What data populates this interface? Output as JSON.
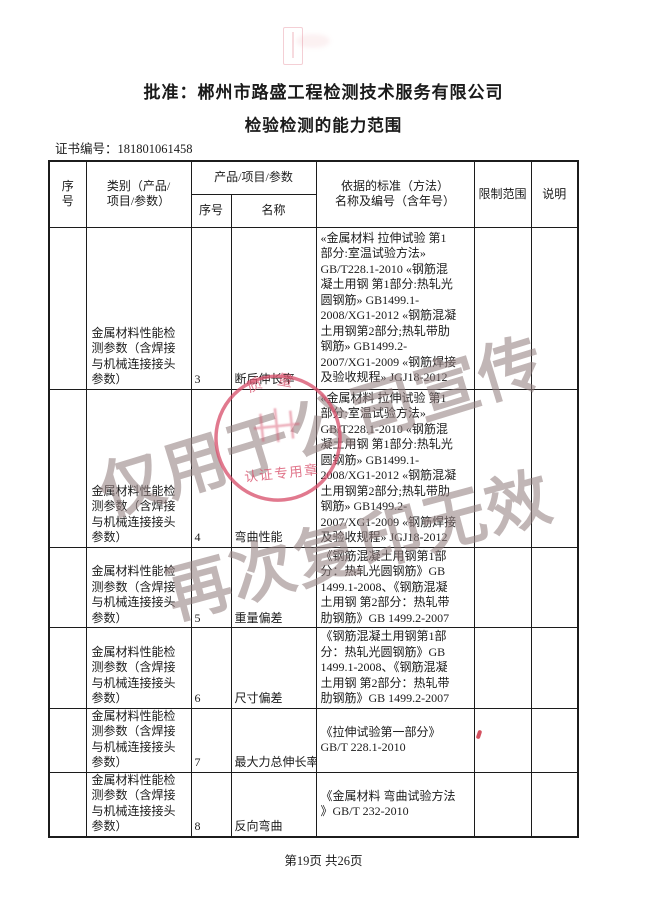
{
  "page": {
    "title_line1": "批准：郴州市路盛工程检测技术服务有限公司",
    "title_line2": "检验检测的能力范围",
    "cert_no_line": "证书编号：181801061458",
    "footer": "第19页  共26页"
  },
  "table": {
    "headers": {
      "col_seq": "序\n号",
      "col_category": "类别（产品/\n项目/参数）",
      "col_group": "产品/项目/参数",
      "col_sub_seq": "序号",
      "col_sub_name": "名称",
      "col_standard": "依据的标准（方法）\n名称及编号（含年号）",
      "col_limit": "限制范围",
      "col_note": "说明"
    },
    "rows": [
      {
        "seq": "",
        "category": "金属材料性能检\n测参数（含焊接\n与机械连接接头\n参数）",
        "no": "3",
        "name": "断后伸长率",
        "standard": "«金属材料 拉伸试验 第1\n部分:室温试验方法»\nGB/T228.1-2010 «钢筋混\n凝土用钢 第1部分:热轧光\n圆钢筋» GB1499.1-\n2008/XG1-2012 «钢筋混凝\n土用钢第2部分;热轧带肋\n钢筋» GB1499.2-\n2007/XG1-2009 «钢筋焊接\n及验收规程» JGJ18-2012",
        "limit": "",
        "note": ""
      },
      {
        "seq": "",
        "category": "金属材料性能检\n测参数（含焊接\n与机械连接接头\n参数）",
        "no": "4",
        "name": "弯曲性能",
        "standard": "«金属材料 拉伸试验 第1\n部分:室温试验方法»\nGB/T228.1-2010 «钢筋混\n凝土用钢 第1部分:热轧光\n圆钢筋» GB1499.1-\n2008/XG1-2012 «钢筋混凝\n土用钢第2部分;热轧带肋\n钢筋» GB1499.2-\n2007/XG1-2009 «钢筋焊接\n及验收规程» JGJ18-2012",
        "limit": "",
        "note": ""
      },
      {
        "seq": "",
        "category": "金属材料性能检\n测参数（含焊接\n与机械连接接头\n参数）",
        "no": "5",
        "name": "重量偏差",
        "standard": "《钢筋混凝土用钢第1部\n分：热轧光圆钢筋》GB\n1499.1-2008、《钢筋混凝\n土用钢 第2部分：热轧带\n肋钢筋》GB 1499.2-2007",
        "limit": "",
        "note": ""
      },
      {
        "seq": "",
        "category": "金属材料性能检\n测参数（含焊接\n与机械连接接头\n参数）",
        "no": "6",
        "name": "尺寸偏差",
        "standard": "《钢筋混凝土用钢第1部\n分：热轧光圆钢筋》GB\n1499.1-2008、《钢筋混凝\n土用钢 第2部分：热轧带\n肋钢筋》GB 1499.2-2007",
        "limit": "",
        "note": ""
      },
      {
        "seq": "",
        "category": "金属材料性能检\n测参数（含焊接\n与机械连接接头\n参数）",
        "no": "7",
        "name": "最大力总伸长率",
        "standard": "《拉伸试验第一部分》\nGB/T 228.1-2010",
        "limit": "",
        "note": ""
      },
      {
        "seq": "",
        "category": "金属材料性能检\n测参数（含焊接\n与机械连接接头\n参数）",
        "no": "8",
        "name": "反向弯曲",
        "standard": "《金属材料 弯曲试验方法\n》GB/T 232-2010",
        "limit": "",
        "note": ""
      }
    ]
  },
  "stamps": {
    "watermark_line1": "仅用于公司宣传",
    "watermark_line2": "再次复印无效",
    "seal_arc_text": "质 量",
    "seal_bottom_text": "认证专用章",
    "colors": {
      "seal_red": "#d8506b",
      "watermark_gray": "#948282",
      "tick_red": "#cc3344"
    }
  }
}
